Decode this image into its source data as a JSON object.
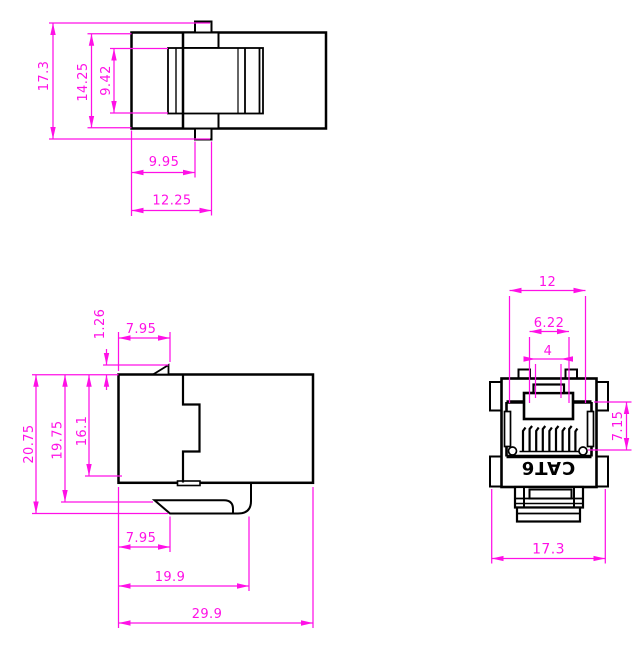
{
  "colors": {
    "line": "#000000",
    "dimension": "#ff10e6",
    "background": "#ffffff"
  },
  "product_label": "CAT6",
  "views": {
    "top": {
      "dims": {
        "overall_height": "17.3",
        "body_height": "14.25",
        "inner_height": "9.42",
        "tab_left_offset": "9.95",
        "tab_right_offset": "12.25"
      }
    },
    "side": {
      "dims": {
        "latch_rise": "1.26",
        "latch_end_offset": "7.95",
        "overall_height": "20.75",
        "height_to_hook": "19.75",
        "flange_height": "16.1",
        "hook_tip_offset": "7.95",
        "hook_depth": "19.9",
        "overall_depth": "29.9"
      }
    },
    "front": {
      "dims": {
        "opening_width": "12",
        "latch_width": "6.22",
        "latch_tab_width": "4",
        "opening_height": "7.15",
        "overall_width": "17.3"
      }
    }
  }
}
